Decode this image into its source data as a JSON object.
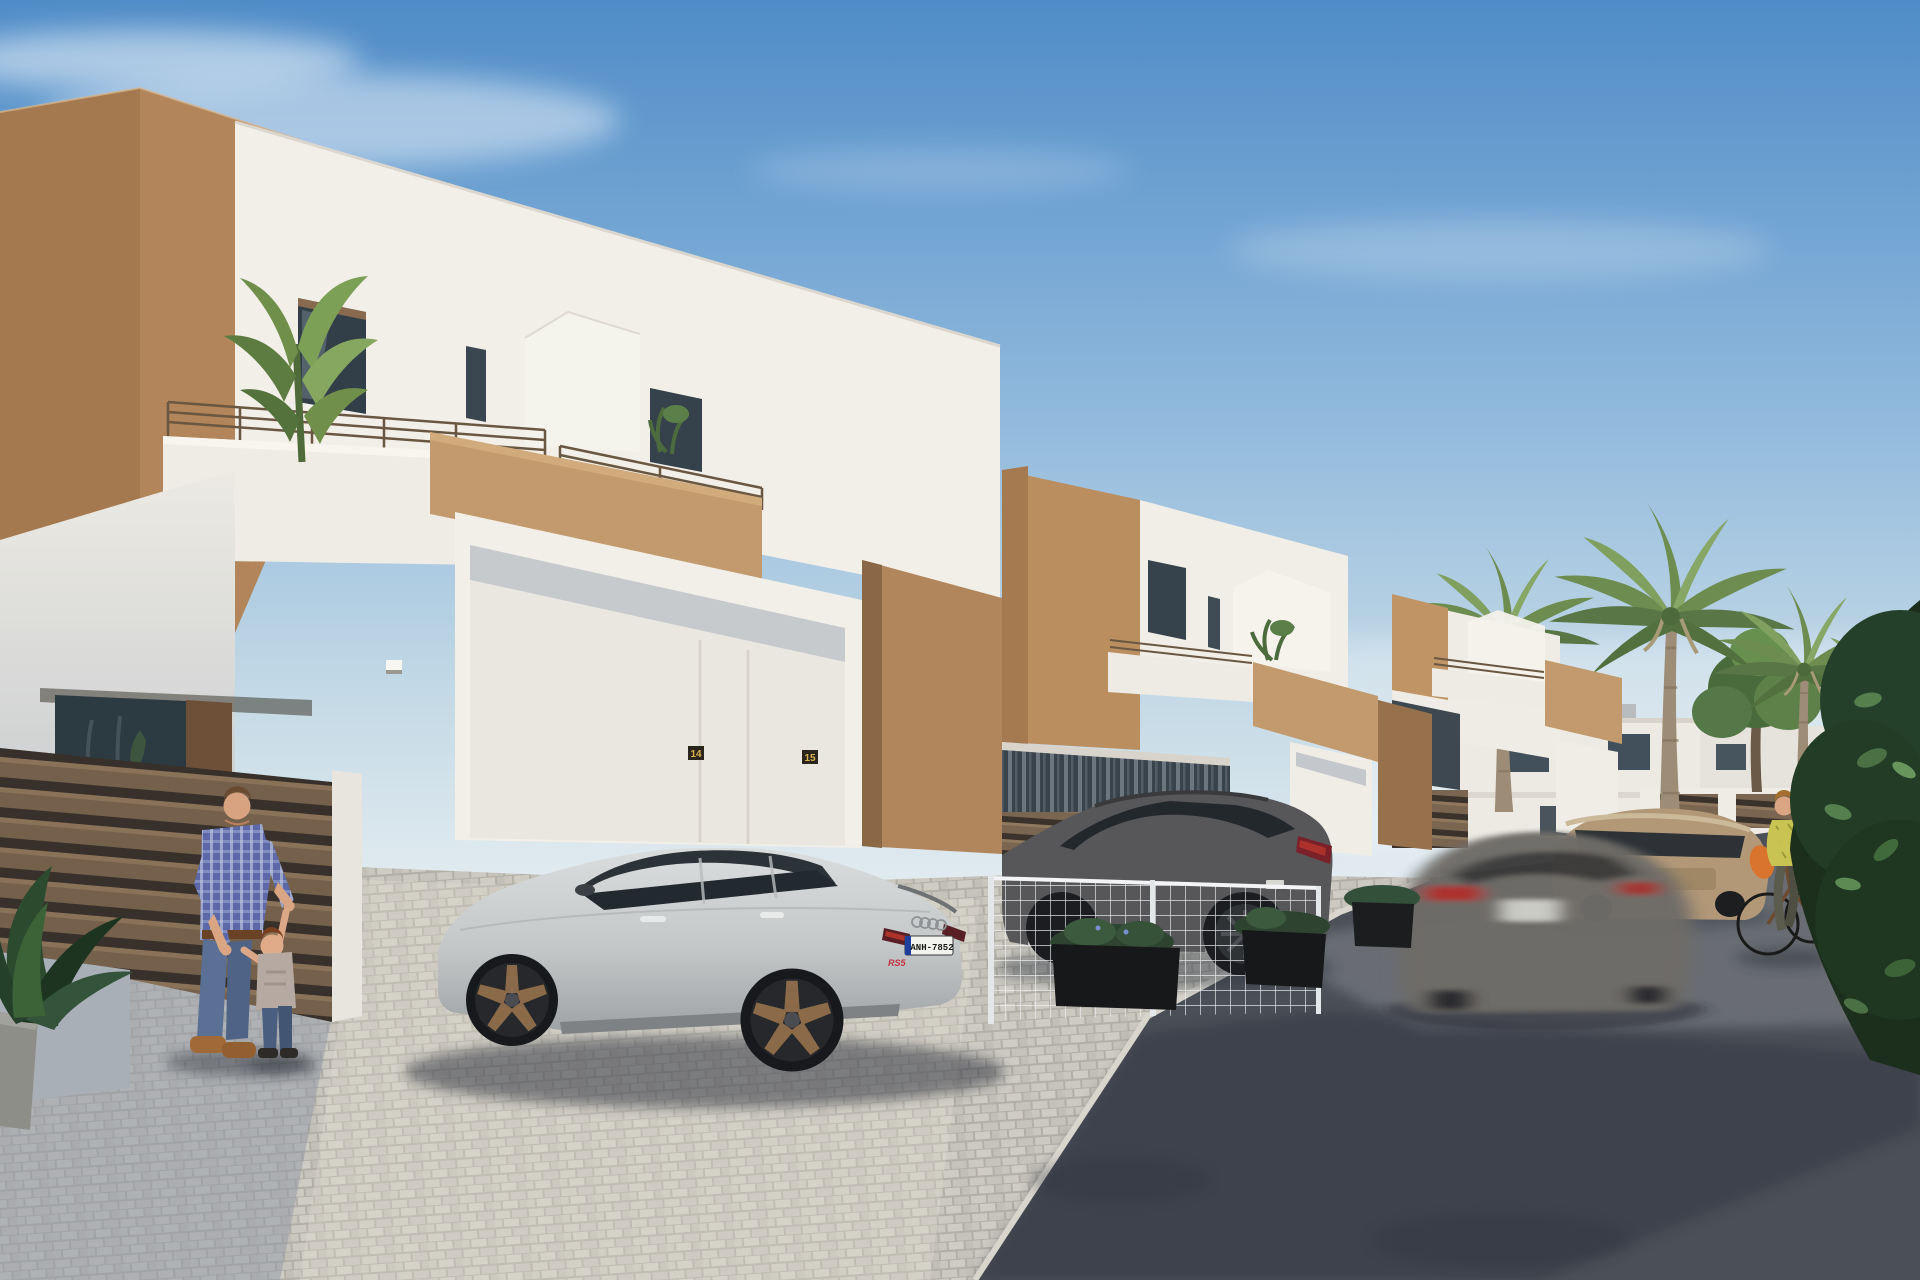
{
  "scene": {
    "description": "Sunny 3D architectural rendering of a street of new two-storey white townhouses with tan accent walls, parked cars, palm trees, a father playing with a toddler and a woman cycling",
    "texts": {
      "audi_license_plate": "ANH-7852",
      "audi_model_badge": "RS5",
      "house_number_unit_left": "14",
      "house_number_unit_right": "15"
    },
    "palette": {
      "sky_top": "#4f8cc7",
      "sky_horizon": "#dde8ee",
      "wall_white_sun": "#f2efe8",
      "wall_white_shade": "#c9ccd1",
      "accent_tan_sun": "#c0956a",
      "accent_tan_shade": "#8f6c49",
      "road_dark": "#4b4f57",
      "road_lit": "#82868b",
      "paving_light": "#ccc9c1",
      "paving_shadow": "#8f97a6",
      "fence_brown": "#74604b",
      "foliage_dark": "#22381f",
      "palm_green": "#7d9c5e",
      "car_silver": "#c9cccd",
      "car_dark_gray": "#57575a",
      "car_blur_gray": "#6e6c68",
      "car_gold": "#b39878",
      "shirt_plaid_blue": "#5c68a8",
      "jeans_blue": "#5a7094",
      "cyclist_blouse": "#c8c352",
      "bag_orange": "#d8742e",
      "flowers_pink": "#d06fa2",
      "plate_blue_band": "#1f3f9e"
    },
    "objects": [
      {
        "name": "townhouse-1",
        "label": "large white townhouse with tan accent walls, balcony, banana plant and double garage entrance"
      },
      {
        "name": "townhouse-2",
        "label": "middle townhouse with frosted gable privacy screen and balcony plant"
      },
      {
        "name": "townhouse-3",
        "label": "third townhouse further down the street"
      },
      {
        "name": "background-villas",
        "label": "white villas at the end of the street"
      },
      {
        "name": "audi-rs5",
        "label": "silver Audi RS5 sportback with bronze wheels parked on cobble driveway"
      },
      {
        "name": "mazda-suv",
        "label": "dark grey SUV parked behind a white mesh fence"
      },
      {
        "name": "moving-hatchback",
        "label": "motion-blurred grey hatchback driving along the road"
      },
      {
        "name": "gold-suv",
        "label": "beige-gold SUV parked further down the street"
      },
      {
        "name": "father-and-toddler",
        "label": "man in blue plaid shirt and jeans playing with a toddler"
      },
      {
        "name": "cyclist",
        "label": "woman in yellow-green blouse with orange bag riding a bicycle"
      },
      {
        "name": "palm-trees",
        "label": "tall palm trees along the street"
      },
      {
        "name": "foreground-hedge",
        "label": "dark green hedge overhanging the road on the right"
      },
      {
        "name": "potted-plant",
        "label": "potted plant in the left foreground"
      }
    ]
  }
}
